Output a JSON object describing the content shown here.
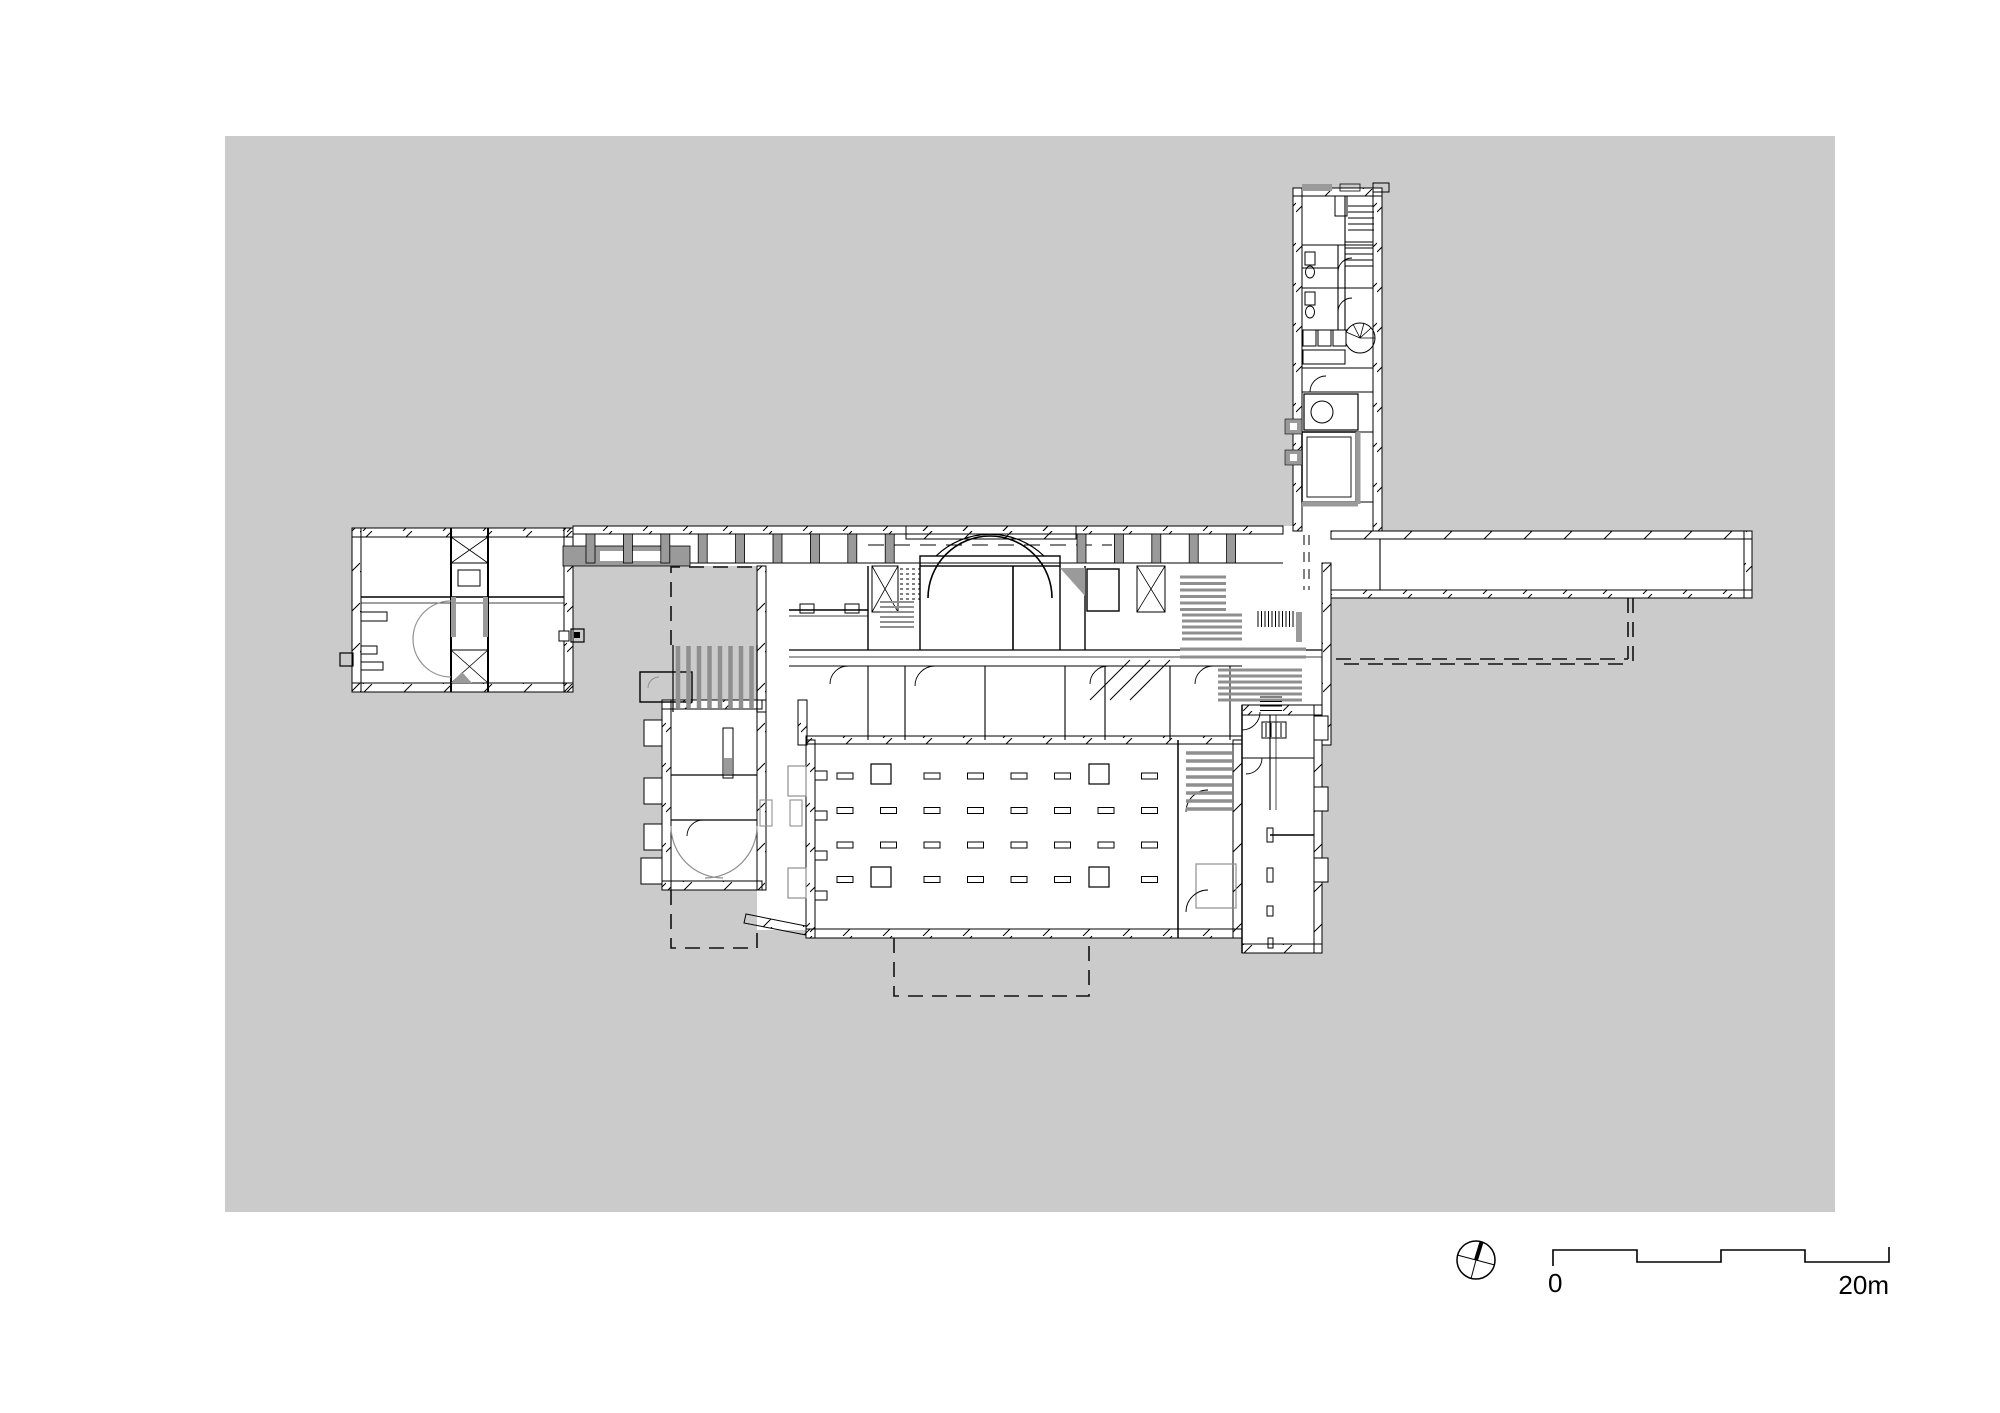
{
  "drawing": {
    "type": "architectural-floor-plan",
    "colors": {
      "canvas": "#cbcbcb",
      "ink": "#000000",
      "mid_gray": "#9a9a9a",
      "light_gray": "#8f8f8f",
      "paper": "#ffffff"
    }
  },
  "scale_bar": {
    "zero_label": "0",
    "end_label": "20m",
    "segments": 4,
    "meters_total": 20
  },
  "north_arrow": {
    "symbol": "compass-circle-with-needle"
  },
  "plan": {
    "generators": [
      {
        "name": "colonnade-piers-west",
        "t": "rrow",
        "x": 586,
        "y": 534,
        "w": 9,
        "h": 29,
        "n": 9,
        "dx": 37.4,
        "fill": "#9a9a9a",
        "stroke": "#000",
        "sw": 0.8
      },
      {
        "name": "colonnade-piers-east",
        "t": "rrow",
        "x": 1077,
        "y": 534,
        "w": 9,
        "h": 29,
        "n": 5,
        "dx": 37.4,
        "fill": "#9a9a9a",
        "stroke": "#000",
        "sw": 0.8
      },
      {
        "name": "hall-columns",
        "t": "rgrid",
        "x": 837,
        "y": 773,
        "w": 16,
        "h": 6,
        "cols": 8,
        "rows": 4,
        "dx": 43.5,
        "dy": 34.5,
        "skip": [
          [
            1,
            0
          ],
          [
            6,
            0
          ],
          [
            1,
            3
          ],
          [
            6,
            3
          ]
        ],
        "fill": "#fff",
        "stroke": "#000",
        "sw": 1
      },
      {
        "name": "hall-big-columns",
        "t": "rects",
        "items": [
          [
            871,
            764,
            20,
            20
          ],
          [
            1089,
            764,
            20,
            20
          ],
          [
            871,
            867,
            20,
            20
          ],
          [
            1089,
            867,
            20,
            20
          ]
        ],
        "fill": "#fff",
        "stroke": "#000",
        "sw": 1.2
      },
      {
        "name": "hall-wall-piers",
        "t": "rects",
        "items": [
          [
            815,
            771,
            12,
            9
          ],
          [
            815,
            811,
            12,
            9
          ],
          [
            815,
            851,
            12,
            9
          ],
          [
            815,
            891,
            12,
            9
          ]
        ],
        "fill": "#fff",
        "stroke": "#000",
        "sw": 1
      },
      {
        "name": "ramp-stripes",
        "t": "vl",
        "x": 678,
        "y": 646,
        "h": 62,
        "n": 8,
        "dx": 10.5,
        "stroke": "#8f8f8f",
        "sw": 4.5
      },
      {
        "name": "stair-hall-treads",
        "t": "hl",
        "x": 1186,
        "y": 753,
        "w": 46,
        "n": 8,
        "dy": 8,
        "stroke": "#8f8f8f",
        "sw": 3.5
      },
      {
        "name": "stair-a-treads",
        "t": "hl",
        "x": 1180,
        "y": 577,
        "w": 46,
        "n": 6,
        "dy": 6.5,
        "stroke": "#8f8f8f",
        "sw": 3
      },
      {
        "name": "stair-b-treads",
        "t": "hl",
        "x": 1182,
        "y": 615,
        "w": 60,
        "n": 5,
        "dy": 6,
        "stroke": "#8f8f8f",
        "sw": 3
      },
      {
        "name": "stair-c-treads",
        "t": "hl",
        "x": 1218,
        "y": 670,
        "w": 84,
        "n": 6,
        "dy": 6,
        "stroke": "#8f8f8f",
        "sw": 3
      },
      {
        "name": "stair-d-treads",
        "t": "hl",
        "x": 1260,
        "y": 697,
        "w": 22,
        "n": 5,
        "dy": 4.5,
        "stroke": "#000",
        "sw": 1
      },
      {
        "name": "stair-fine-treads",
        "t": "vl",
        "x": 1258,
        "y": 611,
        "h": 16,
        "n": 11,
        "dx": 3.5,
        "stroke": "#000",
        "sw": 1
      },
      {
        "name": "apse-dashed-stair",
        "t": "hl",
        "x": 900,
        "y": 569,
        "w": 20,
        "n": 7,
        "dy": 5,
        "stroke": "#000",
        "sw": 1,
        "dash": "3,3"
      },
      {
        "name": "apse-small-stair",
        "t": "hl",
        "x": 880,
        "y": 602,
        "w": 34,
        "n": 6,
        "dy": 5,
        "stroke": "#8f8f8f",
        "sw": 2
      },
      {
        "name": "stair-corridor-rails",
        "t": "hl",
        "x": 1180,
        "y": 649,
        "w": 126,
        "n": 2,
        "dy": 8,
        "stroke": "#8f8f8f",
        "sw": 3
      },
      {
        "name": "wing-top-stair",
        "t": "hl",
        "x": 1348,
        "y": 206,
        "w": 26,
        "n": 5,
        "dy": 6,
        "stroke": "#000",
        "sw": 1
      },
      {
        "name": "wing-mid-stair",
        "t": "hl",
        "x": 1345,
        "y": 242,
        "w": 28,
        "n": 5,
        "dy": 6,
        "stroke": "#000",
        "sw": 1
      },
      {
        "name": "wing-shelves",
        "t": "rrow",
        "x": 1303,
        "y": 330,
        "w": 13,
        "h": 16,
        "n": 3,
        "dx": 15,
        "fill": "#fff",
        "stroke": "#000",
        "sw": 1
      },
      {
        "name": "right-wing-piers",
        "t": "rects",
        "items": [
          [
            1314,
            716,
            14,
            24
          ],
          [
            1314,
            787,
            14,
            24
          ],
          [
            1314,
            858,
            14,
            24
          ]
        ],
        "fill": "#fff",
        "stroke": "#000",
        "sw": 1
      },
      {
        "name": "left-wing-buttresses",
        "t": "rects",
        "items": [
          [
            644,
            720,
            18,
            26
          ],
          [
            644,
            778,
            18,
            26
          ],
          [
            644,
            824,
            18,
            26
          ],
          [
            641,
            858,
            21,
            26
          ]
        ],
        "fill": "#fff",
        "stroke": "#000",
        "sw": 1
      },
      {
        "name": "radiator-lines",
        "t": "vl",
        "x": 1266,
        "y": 723,
        "h": 14,
        "n": 4,
        "dx": 5,
        "stroke": "#000",
        "sw": 1
      }
    ]
  }
}
